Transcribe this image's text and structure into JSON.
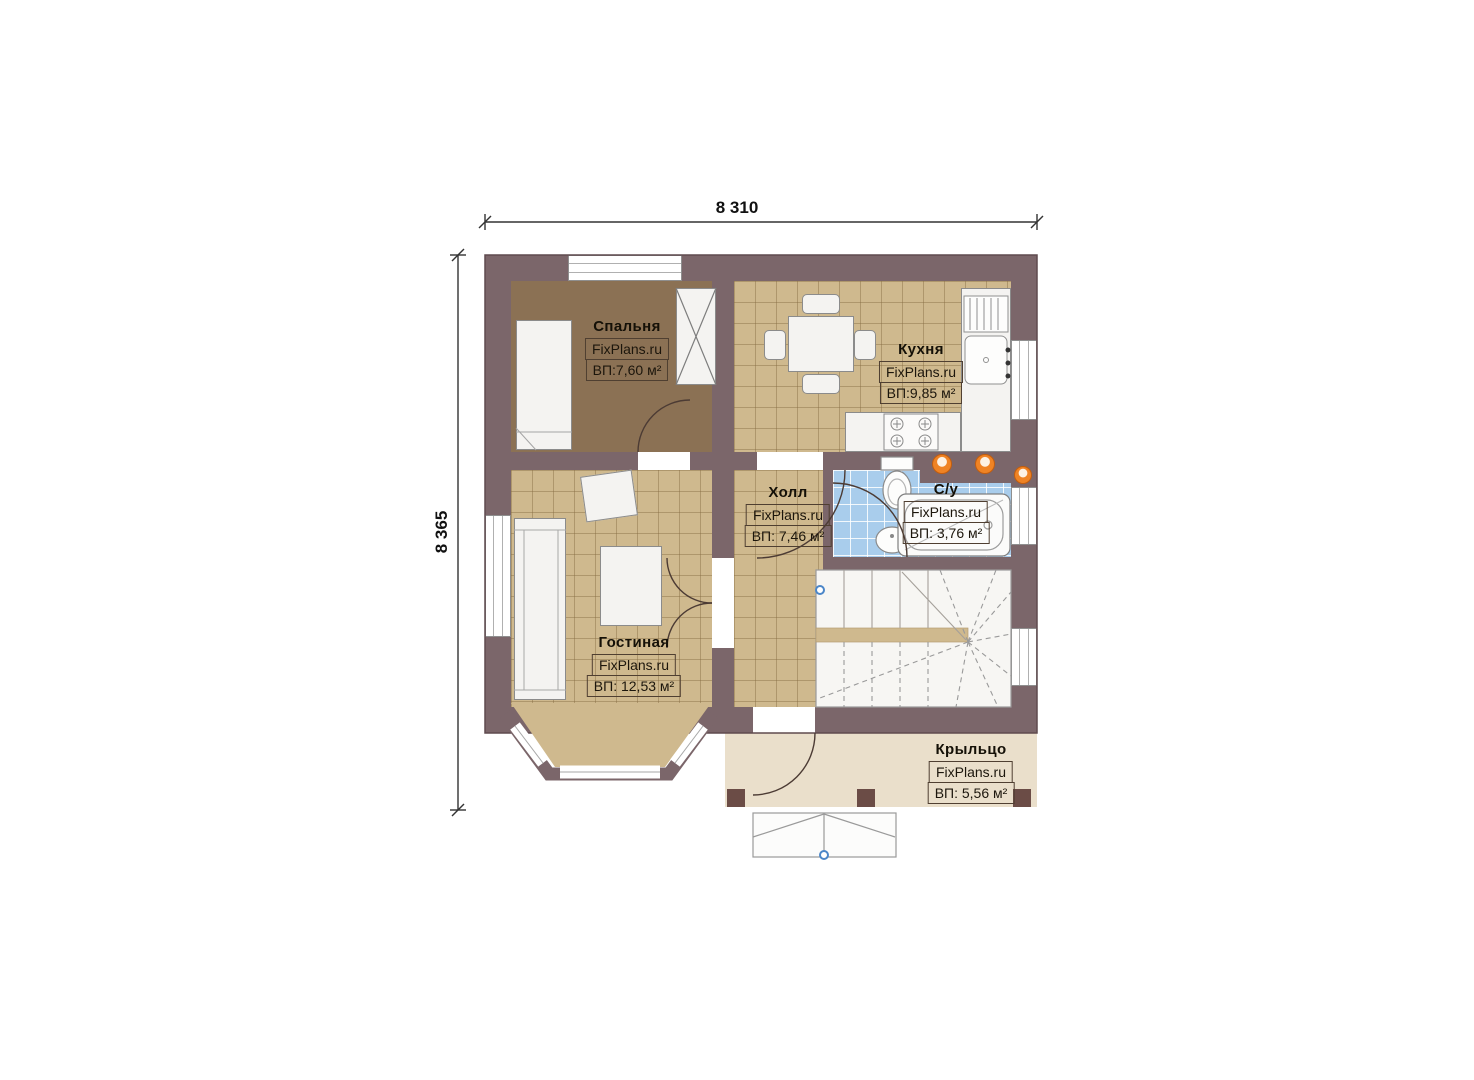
{
  "watermark": "FixPlans.ru",
  "dimensions": {
    "width_top": "8 310",
    "height_left": "8 365"
  },
  "rooms": [
    {
      "key": "bedroom",
      "name": "Спальня",
      "area_label": "ВП:7,60 м²"
    },
    {
      "key": "kitchen",
      "name": "Кухня",
      "area_label": "ВП:9,85 м²"
    },
    {
      "key": "hall",
      "name": "Холл",
      "area_label": "ВП: 7,46 м²"
    },
    {
      "key": "bathroom",
      "name": "С/у",
      "area_label": "ВП: 3,76 м²"
    },
    {
      "key": "living_room",
      "name": "Гостиная",
      "area_label": "ВП: 12,53 м²"
    },
    {
      "key": "porch",
      "name": "Крыльцо",
      "area_label": "ВП: 5,56 м²"
    }
  ],
  "colors": {
    "wall": "#7b666a",
    "bedroom_floor": "#8b7154",
    "tile_floor": "#cfb98e",
    "bathroom_floor": "#a9cdec",
    "porch_floor": "#eadfcb",
    "stair_floor": "#f7f6f3",
    "accent_orange": "#ef8324",
    "marker_blue": "#4b86c8"
  }
}
